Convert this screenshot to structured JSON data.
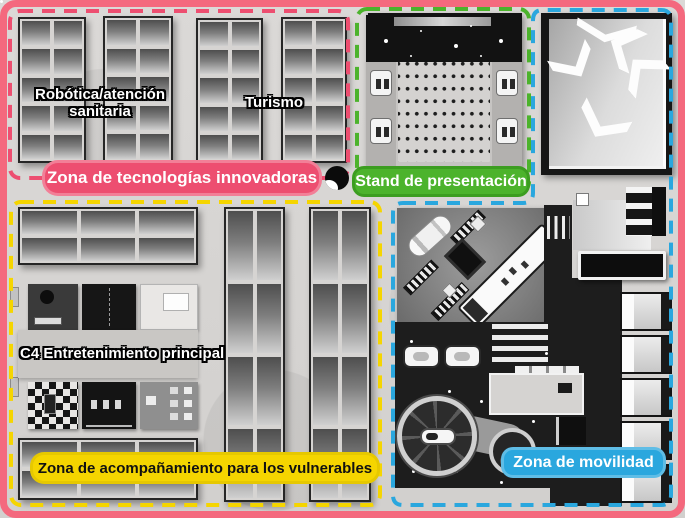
{
  "map": {
    "frame_color": "#F4697E",
    "zones": {
      "innovative_tech": {
        "label": "Zona de tecnologías innovadoras",
        "color": "#ED4E70",
        "areas": {
          "robotics_health": "Robótica/atención sanitaria",
          "tourism": "Turismo"
        }
      },
      "presentation": {
        "label": "Stand de presentación",
        "color": "#4CB32C"
      },
      "companion": {
        "label": "Zona de acompañamiento para los vulnerables",
        "color": "#F5D500",
        "areas": {
          "main_entertainment": "C4 Entretenimiento principal"
        }
      },
      "mobility": {
        "label": "Zona de movilidad",
        "color": "#2AA7DE"
      }
    }
  }
}
